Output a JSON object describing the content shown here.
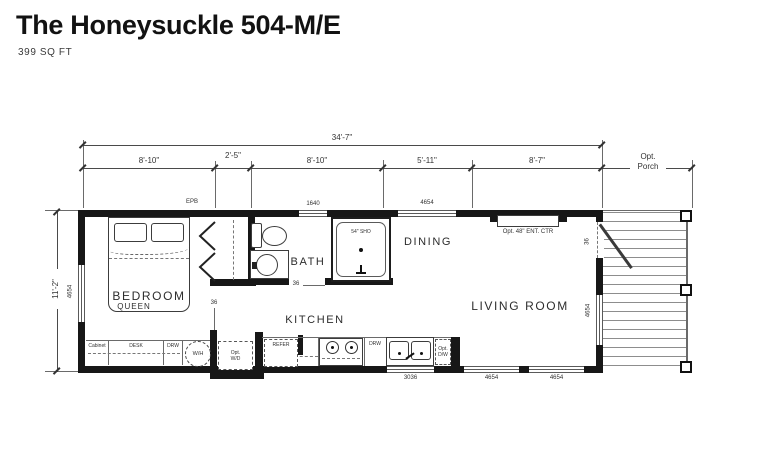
{
  "header": {
    "title": "The Honeysuckle 504-M/E",
    "subtitle": "399 SQ FT"
  },
  "dims": {
    "overall": "34'-7\"",
    "seg1": "8'-10\"",
    "seg2": "2'-5\"",
    "seg3": "8'-10\"",
    "seg4": "5'-11\"",
    "seg5": "8'-7\"",
    "porch_opt": "Opt.",
    "porch_name": "Porch",
    "height": "11'-2\""
  },
  "rooms": {
    "bedroom": "BEDROOM",
    "bed_type": "QUEEN",
    "bath": "BATH",
    "kitchen": "KITCHEN",
    "dining": "DINING",
    "living": "LIVING ROOM"
  },
  "windows": {
    "bath_top": "1640",
    "dining_top": "4654",
    "bedroom_left": "4654",
    "living_right": "4654",
    "kitchen_bottom": "3036",
    "living_bottom_1": "4654",
    "living_bottom_2": "4654"
  },
  "doors": {
    "bedroom": "36",
    "bath": "36",
    "porch": "36"
  },
  "fixtures": {
    "epb": "EPB",
    "shower": "54\" SHO",
    "ent_center": "Opt. 48\" ENT. CTR",
    "cabinet": "Cabinet",
    "desk": "DESK",
    "drawer_bedroom": "DRW",
    "water_heater": "W/H",
    "washer_dryer_opt": "Opt.",
    "washer_dryer": "W/D",
    "refrigerator": "REFER",
    "drawer_kitchen": "DRW",
    "dishwasher_opt": "Opt.",
    "dishwasher": "D/W"
  },
  "colors": {
    "wall": "#171717",
    "line": "#5a5a5a",
    "text": "#2f2f2f"
  }
}
